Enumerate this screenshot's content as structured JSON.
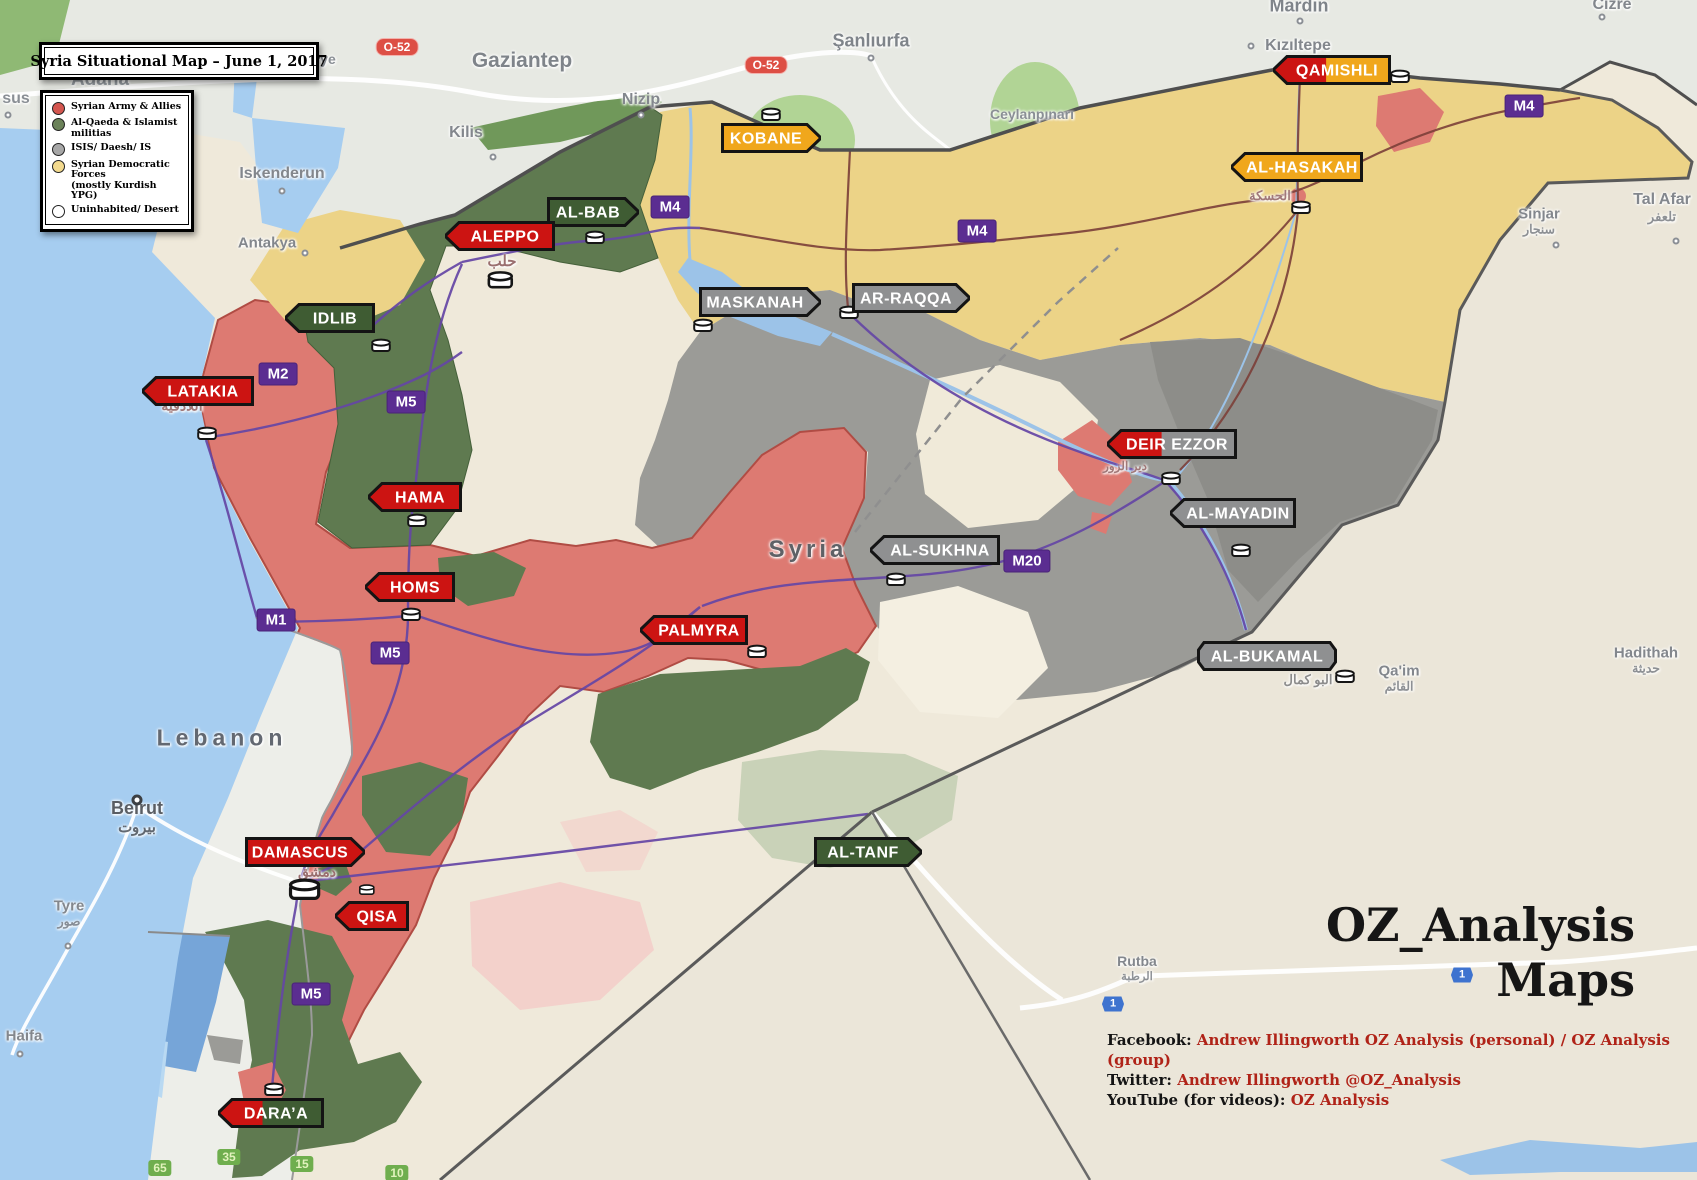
{
  "title": "Syria Situational Map – June 1, 2017",
  "watermark": {
    "line1": "OZ_Analysis",
    "line2": "Maps"
  },
  "credits": [
    {
      "label": "Facebook:",
      "value": "Andrew Illingworth OZ Analysis (personal) / OZ Analysis (group)"
    },
    {
      "label": "Twitter:",
      "value": "Andrew Illingworth @OZ_Analysis"
    },
    {
      "label": "YouTube (for videos):",
      "value": "OZ Analysis"
    }
  ],
  "factions": {
    "government": {
      "label": "Syrian Army & Allies",
      "swatch": "#d4564f",
      "banner": "#cc1412",
      "territory": "#dd7a72"
    },
    "rebels": {
      "label": "Al-Qaeda & Islamist militias",
      "swatch": "#6b8259",
      "banner": "#3f5c33",
      "territory": "#5f7a50"
    },
    "isis": {
      "label": "ISIS/ Daesh/ IS",
      "swatch": "#a7a7a7",
      "banner": "#8f9091",
      "territory": "#9b9b97"
    },
    "sdf": {
      "label": "Syrian Democratic Forces",
      "sub": "(mostly Kurdish YPG)",
      "swatch": "#f3da8e",
      "banner": "#f0a71c",
      "territory": "#ecd387"
    },
    "desert": {
      "label": "Uninhabited/ Desert",
      "swatch": "#ffffff",
      "banner": "#ffffff",
      "territory": "#f0ead9"
    }
  },
  "legend_order": [
    "government",
    "rebels",
    "isis",
    "sdf",
    "desert"
  ],
  "cities": [
    {
      "name": "QAMISHLI",
      "x": 1332,
      "y": 70,
      "w": 118,
      "pointer": "left",
      "factions": [
        "government",
        "sdf"
      ],
      "split": 0.45
    },
    {
      "name": "AL-HASAKAH",
      "x": 1297,
      "y": 167,
      "w": 132,
      "pointer": "left",
      "factions": [
        "sdf"
      ]
    },
    {
      "name": "KOBANE",
      "x": 771,
      "y": 138,
      "w": 100,
      "pointer": "right",
      "factions": [
        "sdf"
      ]
    },
    {
      "name": "AL-BAB",
      "x": 593,
      "y": 212,
      "w": 92,
      "pointer": "right",
      "factions": [
        "rebels"
      ]
    },
    {
      "name": "ALEPPO",
      "x": 500,
      "y": 236,
      "w": 110,
      "pointer": "left",
      "factions": [
        "government"
      ]
    },
    {
      "name": "MASKANAH",
      "x": 760,
      "y": 302,
      "w": 122,
      "pointer": "right",
      "factions": [
        "isis"
      ]
    },
    {
      "name": "AR-RAQQA",
      "x": 911,
      "y": 298,
      "w": 118,
      "pointer": "right",
      "factions": [
        "isis"
      ]
    },
    {
      "name": "IDLIB",
      "x": 330,
      "y": 318,
      "w": 90,
      "pointer": "left",
      "factions": [
        "rebels"
      ]
    },
    {
      "name": "LATAKIA",
      "x": 198,
      "y": 391,
      "w": 112,
      "pointer": "left",
      "factions": [
        "government"
      ]
    },
    {
      "name": "HAMA",
      "x": 415,
      "y": 497,
      "w": 94,
      "pointer": "left",
      "factions": [
        "government"
      ]
    },
    {
      "name": "HOMS",
      "x": 410,
      "y": 587,
      "w": 90,
      "pointer": "left",
      "factions": [
        "government"
      ]
    },
    {
      "name": "AL-SUKHNA",
      "x": 935,
      "y": 550,
      "w": 130,
      "pointer": "left",
      "factions": [
        "isis"
      ]
    },
    {
      "name": "DEIR EZZOR",
      "x": 1172,
      "y": 444,
      "w": 130,
      "pointer": "left",
      "factions": [
        "government",
        "isis"
      ],
      "split": 0.42
    },
    {
      "name": "AL-MAYADIN",
      "x": 1233,
      "y": 513,
      "w": 126,
      "pointer": "left",
      "factions": [
        "isis"
      ]
    },
    {
      "name": "PALMYRA",
      "x": 694,
      "y": 630,
      "w": 108,
      "pointer": "left",
      "factions": [
        "government"
      ]
    },
    {
      "name": "AL-BUKAMAL",
      "x": 1267,
      "y": 656,
      "w": 140,
      "pointer": "none",
      "factions": [
        "isis"
      ]
    },
    {
      "name": "DAMASCUS",
      "x": 305,
      "y": 852,
      "w": 120,
      "pointer": "right",
      "factions": [
        "government"
      ]
    },
    {
      "name": "QISA",
      "x": 372,
      "y": 916,
      "w": 74,
      "pointer": "left",
      "factions": [
        "government"
      ]
    },
    {
      "name": "AL-TANF",
      "x": 868,
      "y": 852,
      "w": 108,
      "pointer": "right",
      "factions": [
        "rebels"
      ]
    },
    {
      "name": "DARA’A",
      "x": 271,
      "y": 1113,
      "w": 106,
      "pointer": "left",
      "factions": [
        "government",
        "rebels"
      ],
      "split": 0.42
    }
  ],
  "markers": [
    {
      "x": 1400,
      "y": 76
    },
    {
      "x": 1301,
      "y": 207
    },
    {
      "x": 771,
      "y": 114
    },
    {
      "x": 595,
      "y": 237
    },
    {
      "x": 500,
      "y": 280,
      "s": 1.3
    },
    {
      "x": 703,
      "y": 325
    },
    {
      "x": 849,
      "y": 312
    },
    {
      "x": 381,
      "y": 345
    },
    {
      "x": 207,
      "y": 433
    },
    {
      "x": 417,
      "y": 520
    },
    {
      "x": 411,
      "y": 614
    },
    {
      "x": 896,
      "y": 579
    },
    {
      "x": 1171,
      "y": 478
    },
    {
      "x": 1241,
      "y": 550
    },
    {
      "x": 757,
      "y": 651
    },
    {
      "x": 1345,
      "y": 676
    },
    {
      "x": 305,
      "y": 890,
      "s": 1.6
    },
    {
      "x": 367,
      "y": 890,
      "s": 0.8
    },
    {
      "x": 274,
      "y": 1089
    }
  ],
  "road_badges": [
    {
      "label": "M4",
      "type": "motorway",
      "x": 670,
      "y": 207
    },
    {
      "label": "M4",
      "type": "motorway",
      "x": 977,
      "y": 231
    },
    {
      "label": "M4",
      "type": "motorway",
      "x": 1524,
      "y": 106
    },
    {
      "label": "M5",
      "type": "motorway",
      "x": 406,
      "y": 402
    },
    {
      "label": "M5",
      "type": "motorway",
      "x": 390,
      "y": 653
    },
    {
      "label": "M5",
      "type": "motorway",
      "x": 311,
      "y": 994
    },
    {
      "label": "M2",
      "type": "motorway",
      "x": 278,
      "y": 374
    },
    {
      "label": "M1",
      "type": "motorway",
      "x": 276,
      "y": 620
    },
    {
      "label": "M20",
      "type": "motorway",
      "x": 1027,
      "y": 561
    },
    {
      "label": "O-52",
      "type": "turkish",
      "x": 397,
      "y": 47
    },
    {
      "label": "O-52",
      "type": "turkish",
      "x": 766,
      "y": 65
    },
    {
      "label": "65",
      "type": "green",
      "x": 160,
      "y": 1168
    },
    {
      "label": "35",
      "type": "green",
      "x": 229,
      "y": 1157
    },
    {
      "label": "15",
      "type": "green",
      "x": 302,
      "y": 1164
    },
    {
      "label": "10",
      "type": "green",
      "x": 397,
      "y": 1173
    },
    {
      "label": "1",
      "type": "blue",
      "x": 1113,
      "y": 1004
    },
    {
      "label": "1",
      "type": "blue",
      "x": 1462,
      "y": 975
    }
  ],
  "places": [
    {
      "t": "sus",
      "x": 16,
      "y": 99,
      "s": 16,
      "c": "#8a8f95",
      "dot": [
        8,
        115
      ]
    },
    {
      "t": "iye",
      "x": 326,
      "y": 59,
      "s": 14,
      "c": "#8a8f95"
    },
    {
      "t": "Adana",
      "x": 100,
      "y": 80,
      "s": 19,
      "c": "#9aa0a6"
    },
    {
      "t": "Gaziantep",
      "x": 522,
      "y": 61,
      "s": 21,
      "c": "#7f848a"
    },
    {
      "t": "Nizip",
      "x": 641,
      "y": 100,
      "s": 16,
      "c": "#83878d",
      "dot": [
        641,
        115
      ]
    },
    {
      "t": "Kilis",
      "x": 466,
      "y": 133,
      "s": 16,
      "c": "#83878d",
      "dot": [
        493,
        157
      ]
    },
    {
      "t": "Şanlıurfa",
      "x": 871,
      "y": 41,
      "s": 18,
      "c": "#7f848a",
      "dot": [
        871,
        58
      ]
    },
    {
      "t": "Ceylanpınarı",
      "x": 1032,
      "y": 114,
      "s": 14,
      "c": "#8a8f95"
    },
    {
      "t": "Mardin",
      "x": 1299,
      "y": 6,
      "s": 18,
      "c": "#7f848a",
      "dot": [
        1300,
        21
      ]
    },
    {
      "t": "Kızıltepe",
      "x": 1298,
      "y": 46,
      "s": 16,
      "c": "#83878d",
      "dot": [
        1251,
        46
      ]
    },
    {
      "t": "Cizre",
      "x": 1612,
      "y": 5,
      "s": 16,
      "c": "#83878d",
      "dot": [
        1602,
        17
      ]
    },
    {
      "t": "Iskenderun",
      "x": 282,
      "y": 174,
      "s": 16,
      "c": "#83878d",
      "dot": [
        282,
        191
      ]
    },
    {
      "t": "Antakya",
      "x": 267,
      "y": 243,
      "s": 15,
      "c": "#83878d",
      "dot": [
        305,
        253
      ]
    },
    {
      "t": "Tal Afar",
      "x": 1662,
      "y": 208,
      "s": 16,
      "c": "#83878d",
      "sub": "تلعفر",
      "dot": [
        1676,
        241
      ]
    },
    {
      "t": "Sinjar",
      "x": 1539,
      "y": 221,
      "s": 15,
      "c": "#83878d",
      "sub": "سنجار",
      "dot": [
        1556,
        245
      ]
    },
    {
      "t": "Syria",
      "x": 808,
      "y": 550,
      "s": 24,
      "c": "#5f6166",
      "ls": 4,
      "fw": 700
    },
    {
      "t": "Lebanon",
      "x": 222,
      "y": 738,
      "s": 23,
      "c": "#636871",
      "ls": 5,
      "fw": 600
    },
    {
      "t": "Beirut",
      "x": 137,
      "y": 817,
      "s": 18,
      "c": "#5a5e64",
      "sub": "بيروت",
      "fw": 700,
      "bigdot": [
        137,
        800
      ]
    },
    {
      "t": "Tyre",
      "x": 69,
      "y": 913,
      "s": 15,
      "c": "#83878d",
      "sub": "صور",
      "dot": [
        68,
        946
      ]
    },
    {
      "t": "Haifa",
      "x": 24,
      "y": 1036,
      "s": 15,
      "c": "#83878d",
      "dot": [
        20,
        1054
      ]
    },
    {
      "t": "Qa'im",
      "x": 1399,
      "y": 678,
      "s": 15,
      "c": "#83878d",
      "sub": "القائم"
    },
    {
      "t": "Hadithah",
      "x": 1646,
      "y": 660,
      "s": 15,
      "c": "#83878d",
      "sub": "حديثة"
    },
    {
      "t": "Rutba",
      "x": 1137,
      "y": 968,
      "s": 14,
      "c": "#83878d",
      "sub": "الرطبة"
    },
    {
      "t": "اللاذقية",
      "x": 182,
      "y": 406,
      "s": 14,
      "c": "#a07878"
    },
    {
      "t": "حلب",
      "x": 502,
      "y": 261,
      "s": 15,
      "c": "#9a6f6f"
    },
    {
      "t": "دمشق",
      "x": 317,
      "y": 872,
      "s": 14,
      "c": "#9a6f6f"
    },
    {
      "t": "الحسكة",
      "x": 1270,
      "y": 196,
      "s": 13,
      "c": "#a07878"
    },
    {
      "t": "البو كمال",
      "x": 1308,
      "y": 680,
      "s": 13,
      "c": "#8c8c8c"
    },
    {
      "t": "دير الزور",
      "x": 1125,
      "y": 466,
      "s": 12,
      "c": "#a07878"
    }
  ]
}
